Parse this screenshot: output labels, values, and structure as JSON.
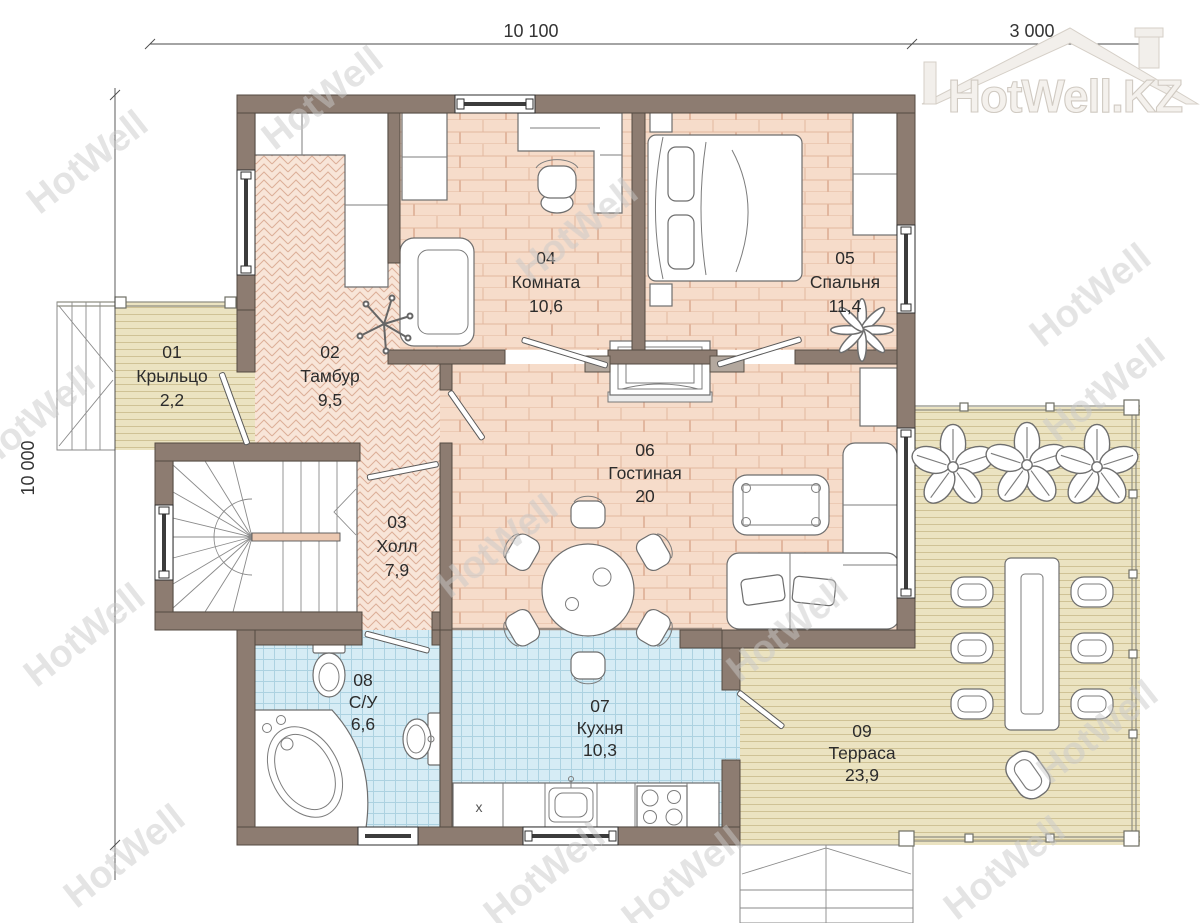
{
  "logo": {
    "text": "HotWell.KZ"
  },
  "watermark": {
    "text": "HotWell"
  },
  "dimensions": {
    "top": "10 100",
    "top_right": "3 000",
    "left": "10 000"
  },
  "rooms": [
    {
      "number": "01",
      "name": "Крыльцо",
      "area": "2,2",
      "floor": "deck"
    },
    {
      "number": "02",
      "name": "Тамбур",
      "area": "9,5",
      "floor": "herringbone"
    },
    {
      "number": "03",
      "name": "Холл",
      "area": "7,9",
      "floor": "herringbone"
    },
    {
      "number": "04",
      "name": "Комната",
      "area": "10,6",
      "floor": "wood"
    },
    {
      "number": "05",
      "name": "Спальня",
      "area": "11,4",
      "floor": "wood"
    },
    {
      "number": "06",
      "name": "Гостиная",
      "area": "20",
      "floor": "wood"
    },
    {
      "number": "07",
      "name": "Кухня",
      "area": "10,3",
      "floor": "tile"
    },
    {
      "number": "08",
      "name": "С/У",
      "area": "6,6",
      "floor": "tile"
    },
    {
      "number": "09",
      "name": "Терраса",
      "area": "23,9",
      "floor": "deck"
    }
  ],
  "kitchen": {
    "fridge_label": "x"
  },
  "colors": {
    "wall": "#8d7c71",
    "wood_floor": "#f6dcca",
    "herringbone_floor": "#f8e5d8",
    "tile_floor": "#d6ecf5",
    "deck_floor": "#ebe3c1",
    "watermark": "#c9c9c9"
  }
}
